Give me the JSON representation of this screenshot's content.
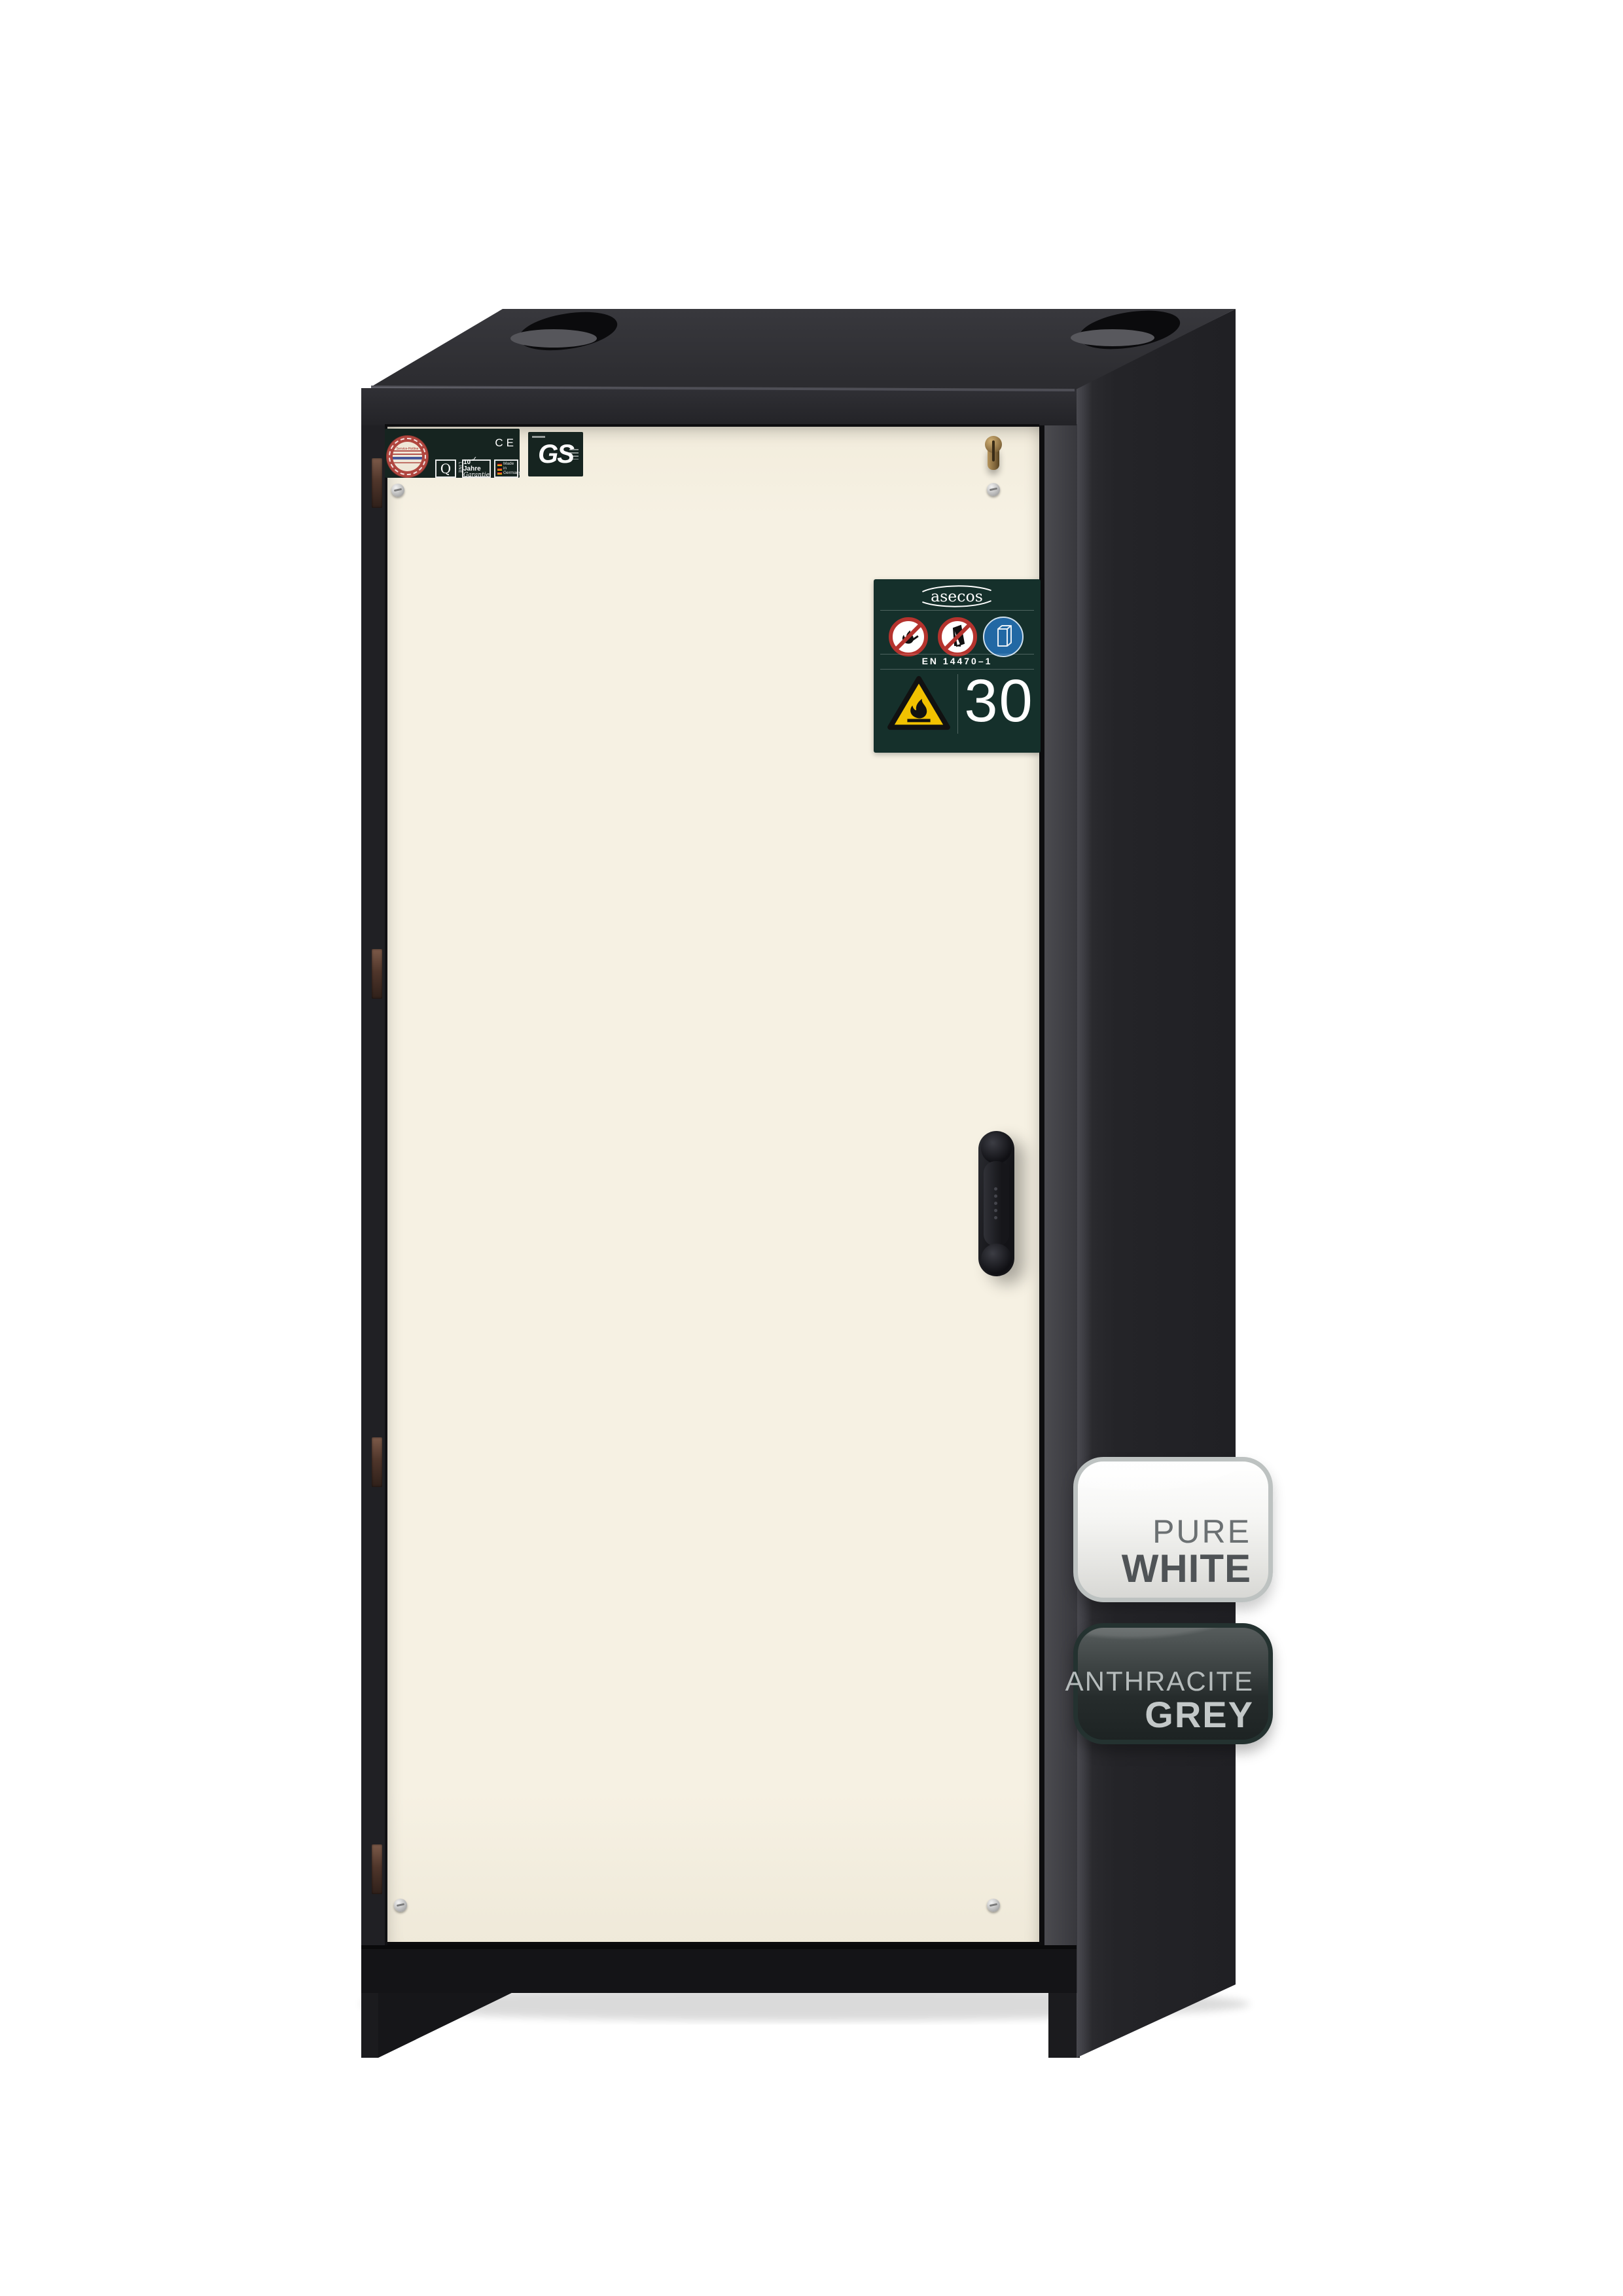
{
  "page": {
    "background_color": "#ffffff"
  },
  "cabinet": {
    "type": "safety storage cabinet",
    "body_color_hex": "#232327",
    "door_color_hex": "#f5f0e1"
  },
  "cert_strip": {
    "seal_text": "Service-Hotline",
    "ce_mark": "CE",
    "q_mark": "Q",
    "q_sub": "LINE",
    "warranty_check": "✓",
    "warranty_line1": "10 Jahre",
    "warranty_line2": "Garantie",
    "made_in_lines": [
      "Made",
      "in",
      "Germany"
    ]
  },
  "gs_mark": {
    "label": "GS"
  },
  "type_plate": {
    "brand": "asecos",
    "standard": "EN 14470–1",
    "fire_rating": "30",
    "background_hex": "#15302b",
    "warning_yellow_hex": "#f2c200",
    "prohibition_red_hex": "#b5332e",
    "mandatory_blue_hex": "#2268a4"
  },
  "swatches": {
    "pure_white": {
      "line1": "PURE",
      "line2": "WHITE",
      "color_hex": "#f0f0ed"
    },
    "anthracite_grey": {
      "line1": "ANTHRACITE",
      "line2": "GREY",
      "color_hex": "#2c3232"
    }
  }
}
